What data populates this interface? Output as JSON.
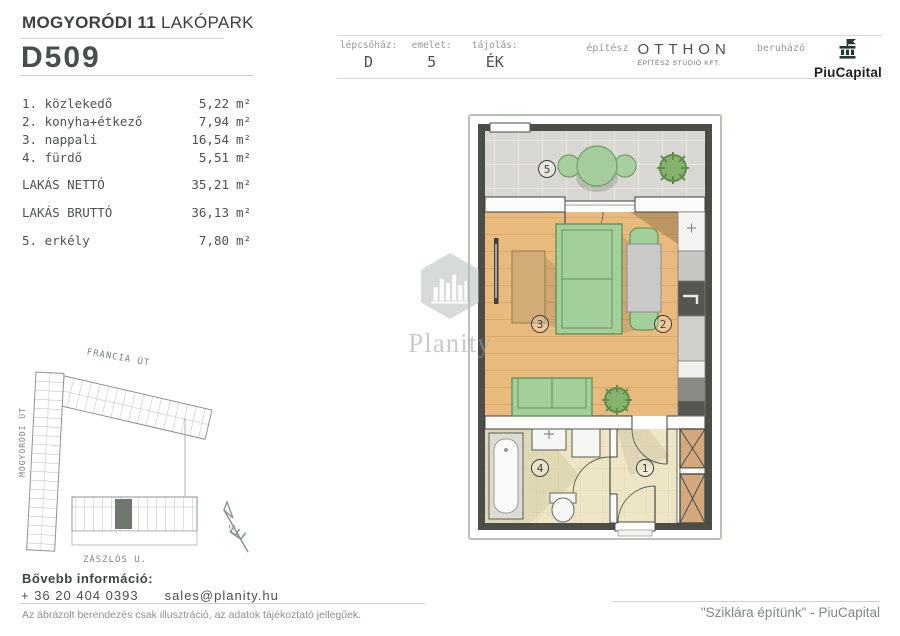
{
  "header": {
    "project_bold": "MOGYORÓDI 11",
    "project_rest": " LAKÓPARK",
    "unit_id": "D509",
    "info": {
      "staircase_label": "lépcsőház:",
      "staircase_value": "D",
      "floor_label": "emelet:",
      "floor_value": "5",
      "orientation_label": "tájolás:",
      "orientation_value": "ÉK",
      "architect_label": "építész",
      "architect_name": "OTTHON",
      "architect_sub": "ÉPÍTÉSZ STÚDIÓ KFT.",
      "developer_label": "beruházó",
      "developer_name": "PiuCapital"
    }
  },
  "rooms": {
    "items": [
      {
        "name": "1. közlekedő",
        "area": "5,22",
        "unit": "m²"
      },
      {
        "name": "2. konyha+étkező",
        "area": "7,94",
        "unit": "m²"
      },
      {
        "name": "3. nappali",
        "area": "16,54",
        "unit": "m²"
      },
      {
        "name": "4. fürdő",
        "area": "5,51",
        "unit": "m²"
      }
    ],
    "net": {
      "name": "LAKÁS NETTÓ",
      "area": "35,21",
      "unit": "m²"
    },
    "gross": {
      "name": "LAKÁS BRUTTÓ",
      "area": "36,13",
      "unit": "m²"
    },
    "balcony": {
      "name": "5. erkély",
      "area": "7,80",
      "unit": "m²"
    }
  },
  "floor_plan": {
    "room_numbers": [
      "1",
      "2",
      "3",
      "4",
      "5"
    ]
  },
  "site_plan": {
    "streets": {
      "top": "FRANCIA ÚT",
      "left": "MOGYORÓDI ÚT",
      "bottom": "ZÁSZLÓS U."
    },
    "compass": "É"
  },
  "watermark": {
    "text": "Planity"
  },
  "footer": {
    "more_info_label": "Bővebb információ:",
    "phone": "+ 36 20 404 0393",
    "email": "sales@planity.hu",
    "disclaimer": "Az ábrázolt berendezés csak illusztráció, az adatok tájékoztató jellegűek.",
    "slogan": "\"Sziklára építünk\" - PiuCapital"
  },
  "colors": {
    "wall_dark": "#4a4e47",
    "wood_floor": "#e9ba7e",
    "tile_floor": "#eee5c4",
    "balcony_tile": "#d8d7d1",
    "furniture_green": "#a3cf9b",
    "furniture_tan": "#d3ab77",
    "logo_green": "#233b2d",
    "text_gray_green": "#4b544e"
  }
}
